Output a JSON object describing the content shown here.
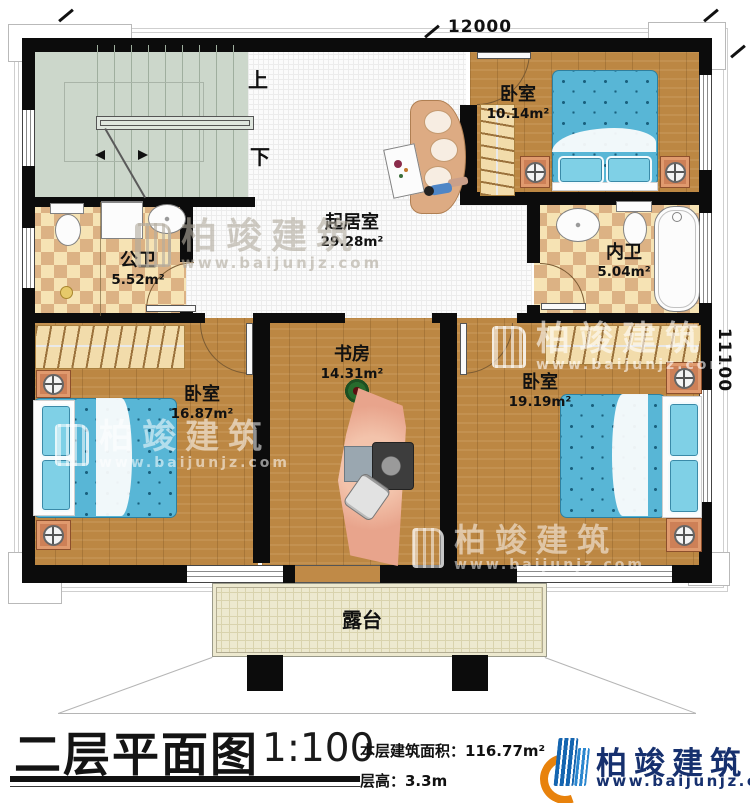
{
  "plan": {
    "dim_top": "12000",
    "dim_right": "11100",
    "stair_up": "上",
    "stair_down": "下",
    "rooms": {
      "living": {
        "name": "起居室",
        "area": "29.28m²"
      },
      "bedroom_top_right": {
        "name": "卧室",
        "area": "10.14m²"
      },
      "public_bath": {
        "name": "公卫",
        "area": "5.52m²"
      },
      "inner_bath": {
        "name": "内卫",
        "area": "5.04m²"
      },
      "bedroom_bottom_left": {
        "name": "卧室",
        "area": "16.87m²"
      },
      "study": {
        "name": "书房",
        "area": "14.31m²"
      },
      "bedroom_bottom_right": {
        "name": "卧室",
        "area": "19.19m²"
      },
      "terrace": {
        "name": "露台"
      }
    }
  },
  "watermark": {
    "brand": "柏竣建筑",
    "website": "www.baijunjz.com"
  },
  "footer": {
    "title": "二层平面图",
    "scale": "1:100",
    "floor_area": "本层建筑面积：116.77m²",
    "floor_height": "层高：3.3m",
    "brand": "柏竣建筑",
    "website": "www.baijunjz.com"
  },
  "colors": {
    "wall": "#0c0c0c",
    "wood_floor": "#bc8743",
    "bath_tile_light": "#f6e3b4",
    "bath_tile_dark": "#dcb284",
    "stair_floor": "#ccd7cb",
    "terrace_floor": "#ede9cf",
    "bed_blue": "#58b6d6",
    "brand_navy": "#16306e",
    "brand_orange": "#e8820c"
  }
}
